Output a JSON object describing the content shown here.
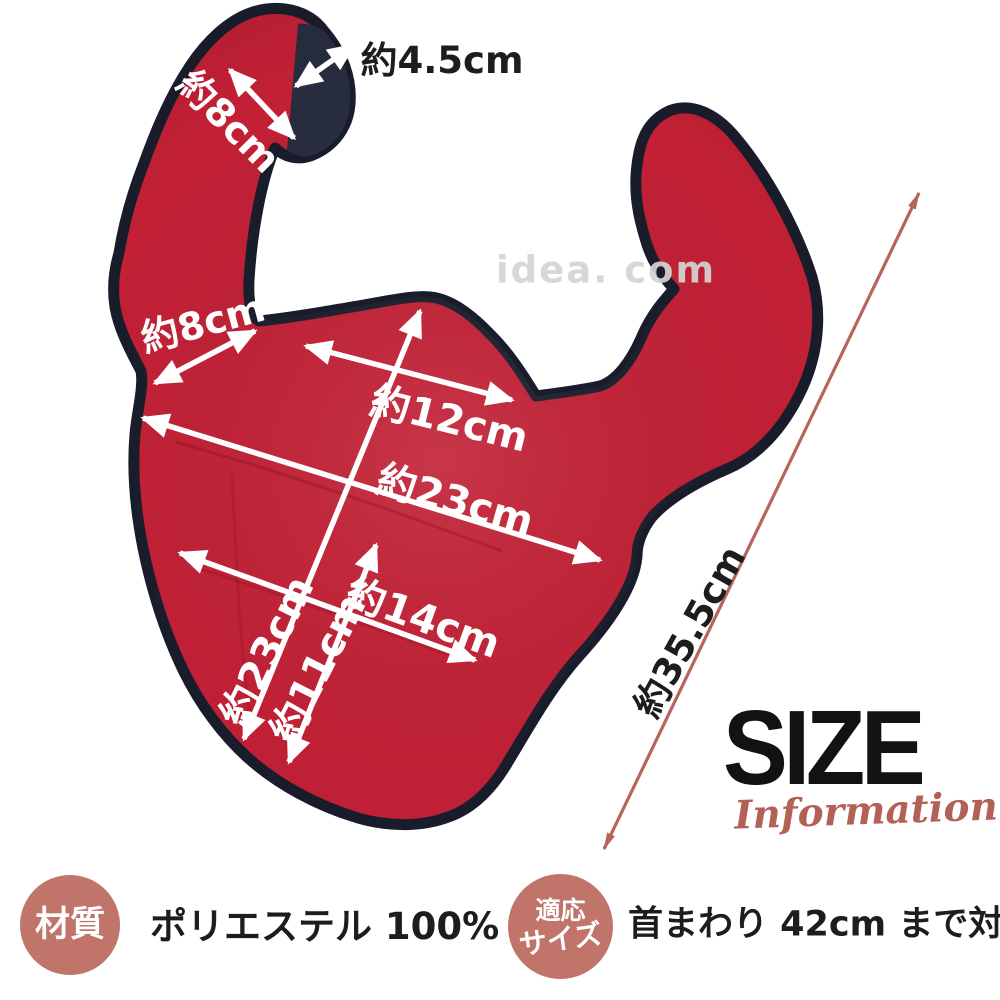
{
  "watermark": "idea. com",
  "measurements": {
    "velcro_width": "約4.5cm",
    "strap_width": "約8cm",
    "shoulder_width": "約8cm",
    "neck_opening_width": "約12cm",
    "body_width": "約23cm",
    "body_height": "約23cm",
    "pocket_height": "約11cm",
    "pocket_width": "約14cm",
    "overall_length": "約35.5cm"
  },
  "title": {
    "main": "SIZE",
    "sub": "Information"
  },
  "specs": {
    "material": {
      "badge": "材質",
      "value": "ポリエステル 100%"
    },
    "fit": {
      "badge_line1": "適応",
      "badge_line2": "サイズ",
      "value": "首まわり 42cm まで対応"
    }
  },
  "colors": {
    "fabric_red": "#c22035",
    "trim_navy": "#191d2b",
    "velcro_navy": "#272d3f",
    "accent_rose": "#b5655a",
    "badge_rose": "#c0746a",
    "arrow_white": "#ffffff"
  }
}
